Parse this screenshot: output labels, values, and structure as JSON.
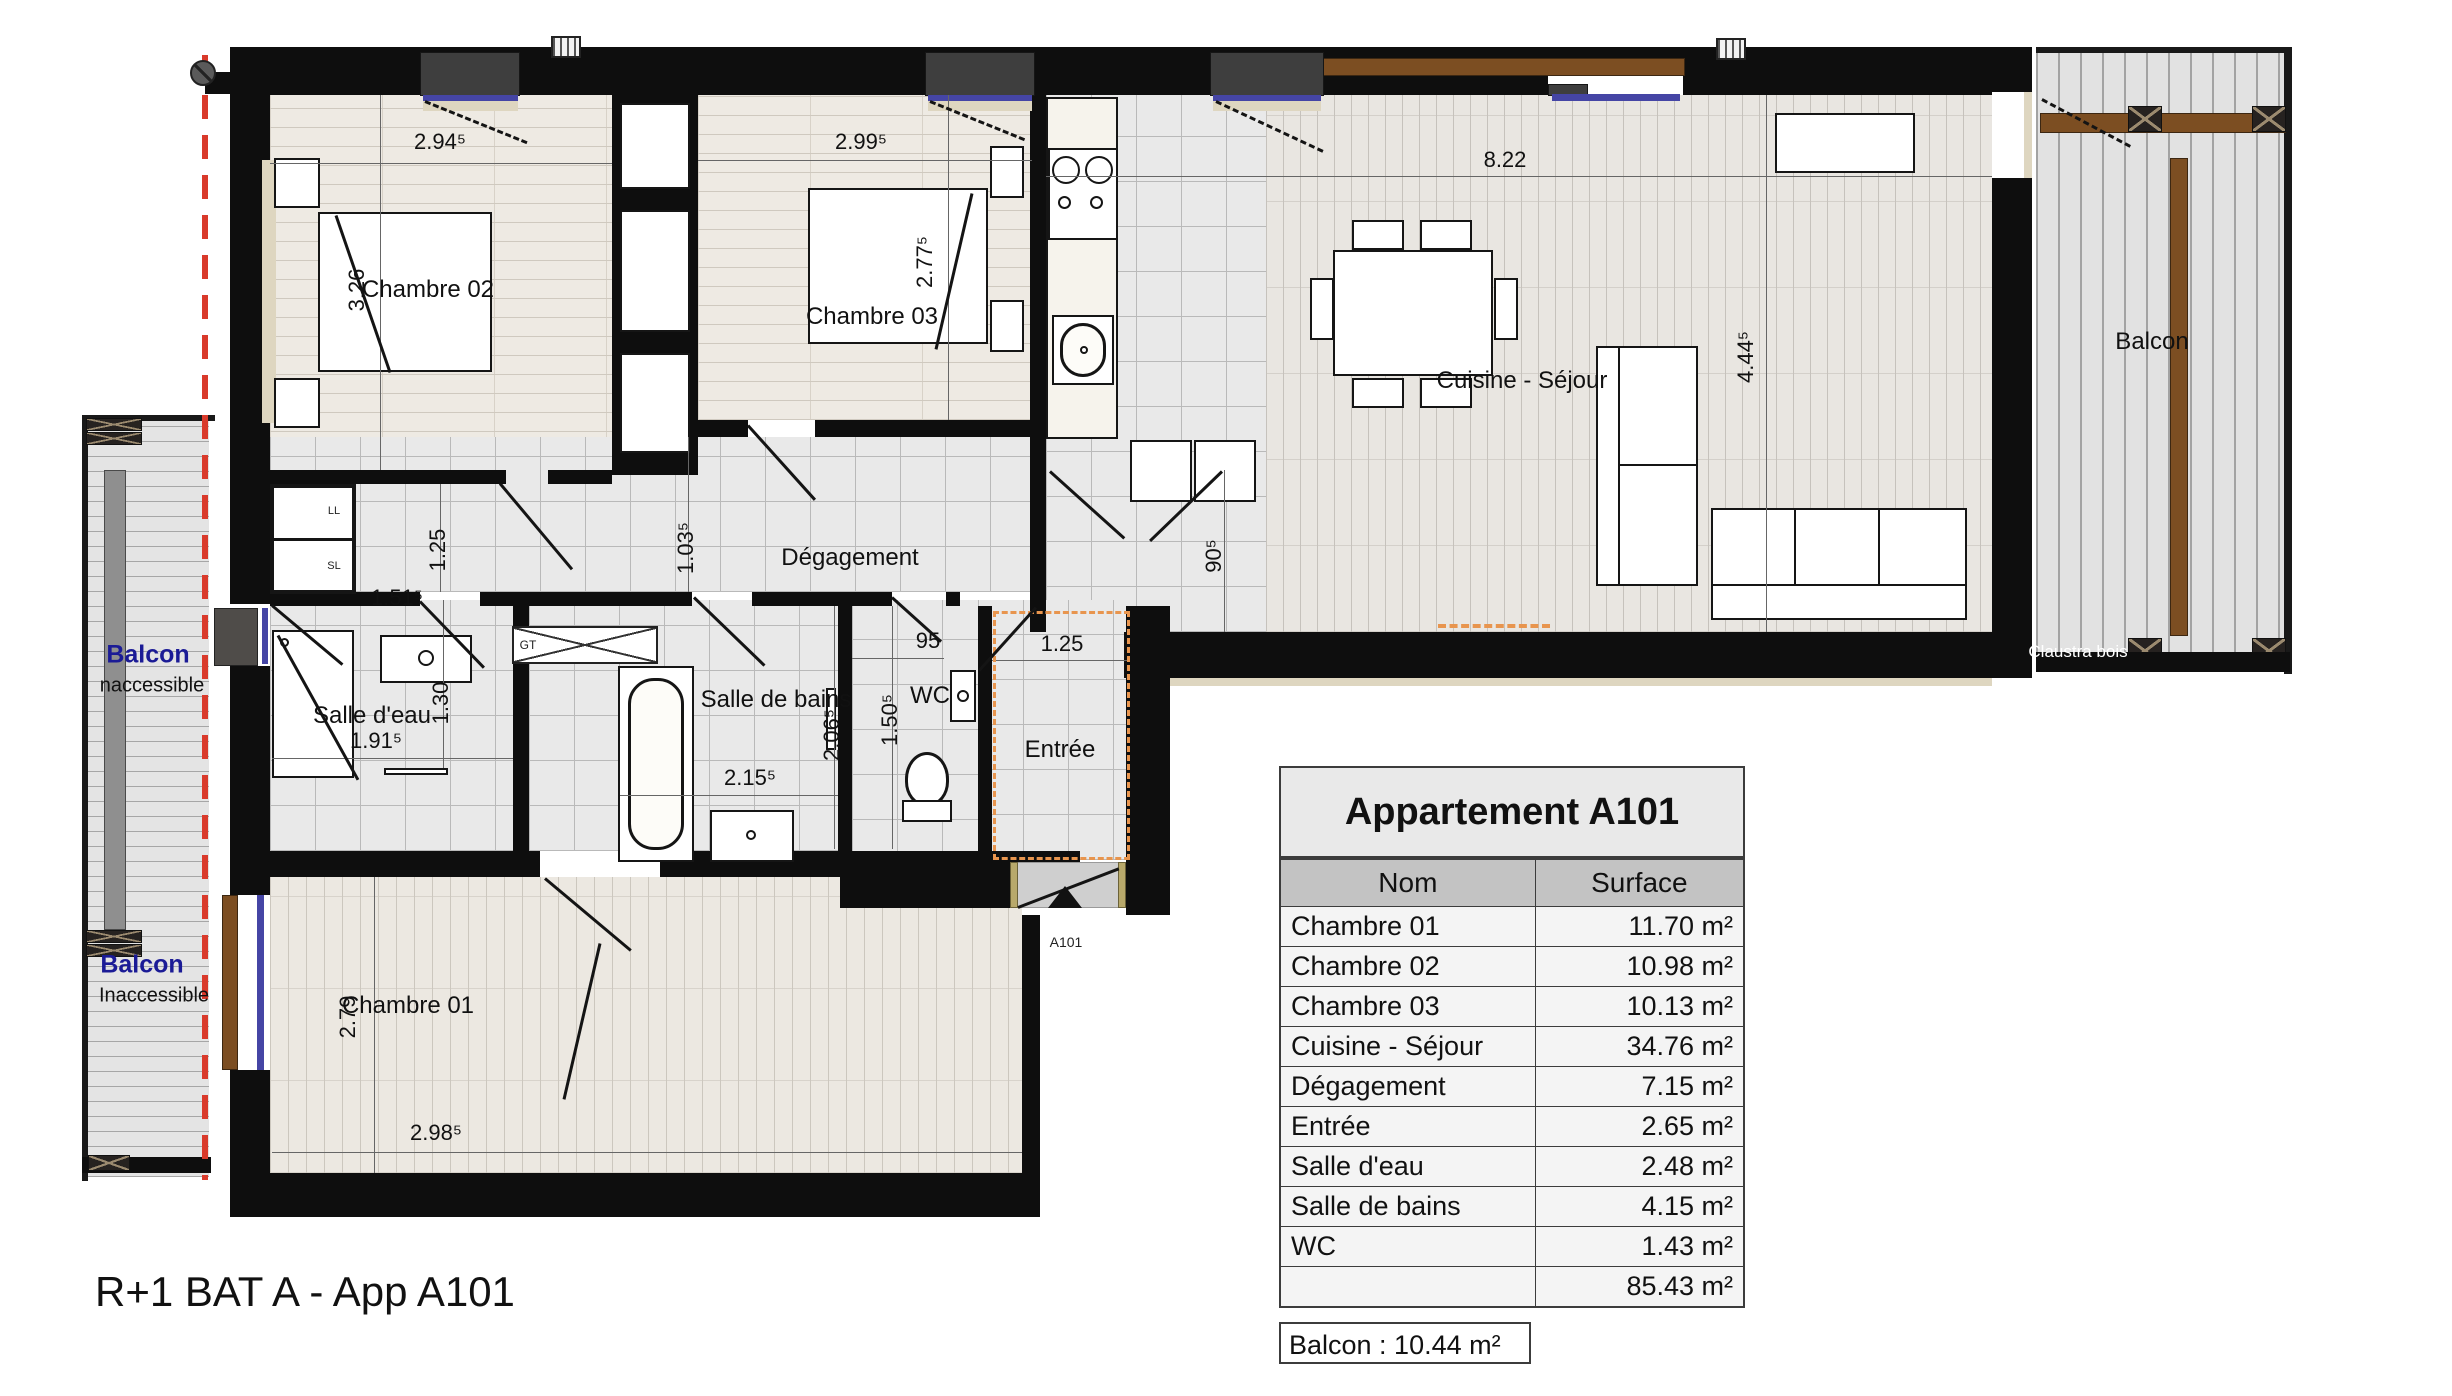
{
  "drawing_title": "R+1 BAT A - App A101",
  "plan": {
    "room_labels": [
      {
        "text": "Chambre 02",
        "x": 428,
        "y": 290
      },
      {
        "text": "Chambre 03",
        "x": 872,
        "y": 317
      },
      {
        "text": "Cuisine - Séjour",
        "x": 1522,
        "y": 381
      },
      {
        "text": "Dégagement",
        "x": 850,
        "y": 558
      },
      {
        "text": "Chambre 01",
        "x": 408,
        "y": 1006
      },
      {
        "text": "Salle d'eau",
        "x": 372,
        "y": 716
      },
      {
        "text": "Salle de bains",
        "x": 776,
        "y": 700
      },
      {
        "text": "WC",
        "x": 930,
        "y": 696
      },
      {
        "text": "Entrée",
        "x": 1060,
        "y": 750
      }
    ],
    "dimensions": [
      {
        "text": "2.94⁵",
        "x": 440,
        "y": 142,
        "vertical": false
      },
      {
        "text": "3.26",
        "x": 357,
        "y": 290,
        "vertical": true
      },
      {
        "text": "2.99⁵",
        "x": 861,
        "y": 142,
        "vertical": false
      },
      {
        "text": "2.77⁵",
        "x": 925,
        "y": 262,
        "vertical": true
      },
      {
        "text": "8.22",
        "x": 1505,
        "y": 160,
        "vertical": false
      },
      {
        "text": "4.44⁵",
        "x": 1746,
        "y": 357,
        "vertical": true
      },
      {
        "text": "1.25",
        "x": 438,
        "y": 550,
        "vertical": true
      },
      {
        "text": "1.51⁵",
        "x": 397,
        "y": 598,
        "vertical": false
      },
      {
        "text": "1.03⁵",
        "x": 686,
        "y": 548,
        "vertical": true
      },
      {
        "text": "90⁵",
        "x": 1214,
        "y": 556,
        "vertical": true
      },
      {
        "text": "95",
        "x": 928,
        "y": 641,
        "vertical": false
      },
      {
        "text": "1.25",
        "x": 1062,
        "y": 644,
        "vertical": false
      },
      {
        "text": "1.91⁵",
        "x": 376,
        "y": 741,
        "vertical": false
      },
      {
        "text": "1.30",
        "x": 441,
        "y": 703,
        "vertical": true
      },
      {
        "text": "2.06⁵",
        "x": 832,
        "y": 735,
        "vertical": true
      },
      {
        "text": "2.15⁵",
        "x": 750,
        "y": 778,
        "vertical": false
      },
      {
        "text": "1.50⁵",
        "x": 890,
        "y": 720,
        "vertical": true
      },
      {
        "text": "2.79",
        "x": 348,
        "y": 1017,
        "vertical": true
      },
      {
        "text": "2.98⁵",
        "x": 436,
        "y": 1133,
        "vertical": false
      }
    ],
    "small_labels": [
      {
        "text": "LL",
        "x": 334,
        "y": 511,
        "size": 11
      },
      {
        "text": "SL",
        "x": 334,
        "y": 566,
        "size": 11
      },
      {
        "text": "GT",
        "x": 528,
        "y": 645,
        "size": 12
      },
      {
        "text": "A101",
        "x": 1066,
        "y": 942,
        "size": 14
      }
    ],
    "balcony_labels": {
      "left_top_title": "Balcon",
      "left_top_sub": "naccessible",
      "left_bottom_title": "Balcon",
      "left_bottom_sub": "Inaccessible",
      "right_title": "Balcon",
      "claustra": "Claustra bois"
    }
  },
  "table": {
    "title": "Appartement A101",
    "columns": [
      "Nom",
      "Surface"
    ],
    "rows": [
      [
        "Chambre 01",
        "11.70 m²"
      ],
      [
        "Chambre 02",
        "10.98 m²"
      ],
      [
        "Chambre 03",
        "10.13 m²"
      ],
      [
        "Cuisine - Séjour",
        "34.76 m²"
      ],
      [
        "Dégagement",
        "7.15 m²"
      ],
      [
        "Entrée",
        "2.65 m²"
      ],
      [
        "Salle d'eau",
        "2.48 m²"
      ],
      [
        "Salle de bains",
        "4.15 m²"
      ],
      [
        "WC",
        "1.43 m²"
      ]
    ],
    "total": "85.43 m²",
    "balcony_note": "Balcon : 10.44 m²"
  },
  "colors": {
    "wall": "#0e0e0e",
    "wood_rail": "#7c4e22",
    "window_glazing_blue": "#4545a5",
    "lot_boundary_red": "#d93a2b",
    "entry_highlight_orange": "#e8954e",
    "balcony_label_blue": "#1b1b96"
  }
}
